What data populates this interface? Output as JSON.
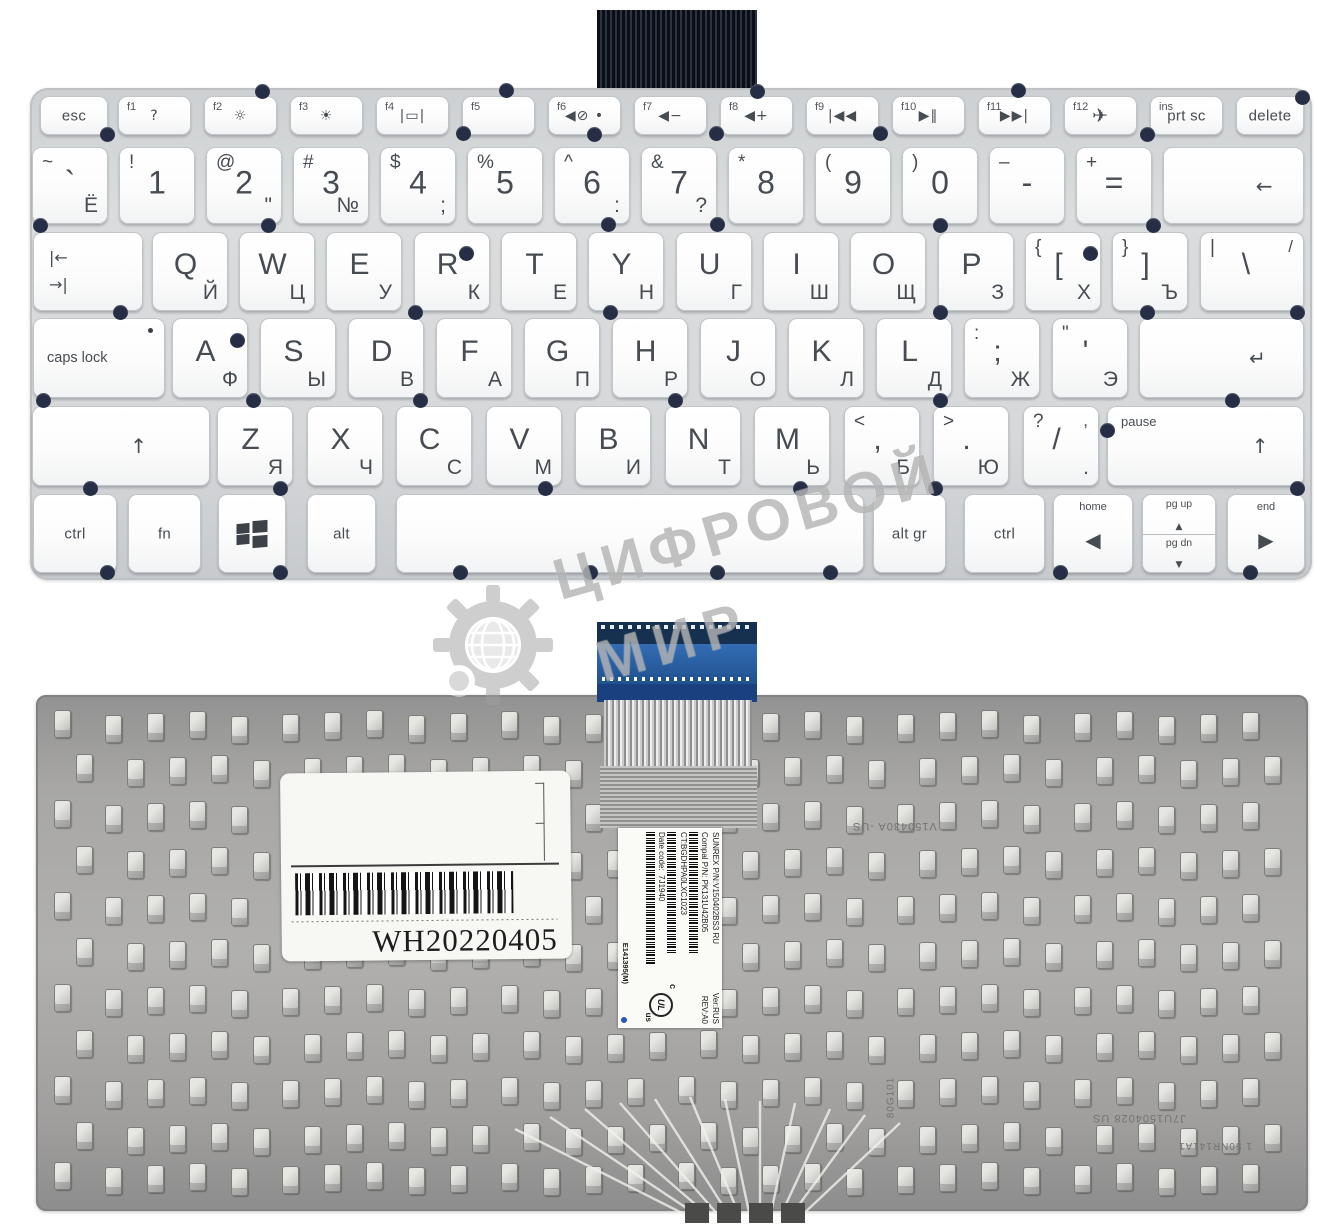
{
  "colors": {
    "cable_blue": "#2a5ca8",
    "front_plate": "#d6d8da",
    "back_plate": "#a5a4a2",
    "screw_dot": "#252e44",
    "key_text": "#474c52"
  },
  "watermark": {
    "word1": "ЦИФРОВОЙ",
    "word2": "МИР"
  },
  "front": {
    "rows": [
      {
        "y": 96,
        "h": 37,
        "cls": "row-fn",
        "mainCls": "word",
        "keys": [
          {
            "id": "esc",
            "x": 40,
            "w": 66,
            "main": "esc"
          },
          {
            "id": "f1",
            "x": 118,
            "w": 71,
            "fn": "f1",
            "icon": "question-icon"
          },
          {
            "id": "f2",
            "x": 204,
            "w": 71,
            "fn": "f2",
            "icon": "brightness-down-icon"
          },
          {
            "id": "f3",
            "x": 290,
            "w": 71,
            "fn": "f3",
            "icon": "brightness-up-icon"
          },
          {
            "id": "f4",
            "x": 376,
            "w": 71,
            "fn": "f4",
            "icon": "display-icon"
          },
          {
            "id": "f5",
            "x": 462,
            "w": 71,
            "fn": "f5"
          },
          {
            "id": "f6",
            "x": 548,
            "w": 71,
            "fn": "f6",
            "icon": "mute-icon"
          },
          {
            "id": "f7",
            "x": 634,
            "w": 71,
            "fn": "f7",
            "icon": "volume-down-icon"
          },
          {
            "id": "f8",
            "x": 720,
            "w": 71,
            "fn": "f8",
            "icon": "volume-up-icon"
          },
          {
            "id": "f9",
            "x": 806,
            "w": 71,
            "fn": "f9",
            "icon": "prev-track-icon"
          },
          {
            "id": "f10",
            "x": 892,
            "w": 71,
            "fn": "f10",
            "icon": "play-pause-icon"
          },
          {
            "id": "f11",
            "x": 978,
            "w": 71,
            "fn": "f11",
            "icon": "next-track-icon"
          },
          {
            "id": "f12",
            "x": 1064,
            "w": 71,
            "fn": "f12",
            "icon": "airplane-icon"
          },
          {
            "id": "prtsc",
            "x": 1150,
            "w": 71,
            "fn": "ins",
            "main": "prt sc"
          },
          {
            "id": "delete",
            "x": 1236,
            "w": 66,
            "main": "delete"
          }
        ]
      },
      {
        "y": 147,
        "h": 75,
        "mainCls": "num",
        "keys": [
          {
            "id": "grave",
            "x": 32,
            "w": 74,
            "tl": "~",
            "main": "`",
            "br": "Ё"
          },
          {
            "id": "1",
            "x": 119,
            "w": 74,
            "tl": "!",
            "main": "1"
          },
          {
            "id": "2",
            "x": 206,
            "w": 74,
            "tl": "@",
            "main": "2",
            "br": "\""
          },
          {
            "id": "3",
            "x": 293,
            "w": 74,
            "tl": "#",
            "main": "3",
            "br": "№"
          },
          {
            "id": "4",
            "x": 380,
            "w": 74,
            "tl": "$",
            "main": "4",
            "br": ";"
          },
          {
            "id": "5",
            "x": 467,
            "w": 74,
            "tl": "%",
            "main": "5"
          },
          {
            "id": "6",
            "x": 554,
            "w": 74,
            "tl": "^",
            "main": "6",
            "br": ":"
          },
          {
            "id": "7",
            "x": 641,
            "w": 74,
            "tl": "&",
            "main": "7",
            "br": "?"
          },
          {
            "id": "8",
            "x": 728,
            "w": 74,
            "tl": "*",
            "main": "8"
          },
          {
            "id": "9",
            "x": 815,
            "w": 74,
            "tl": "(",
            "main": "9"
          },
          {
            "id": "0",
            "x": 902,
            "w": 74,
            "tl": ")",
            "main": "0"
          },
          {
            "id": "minus",
            "x": 989,
            "w": 74,
            "tl": "–",
            "main": "-"
          },
          {
            "id": "equals",
            "x": 1076,
            "w": 74,
            "tl": "+",
            "main": "="
          },
          {
            "id": "backspace",
            "x": 1163,
            "w": 139,
            "icon": "backspace-icon",
            "ix": 72
          }
        ]
      },
      {
        "y": 232,
        "h": 77,
        "mainCls": "alpha",
        "keys": [
          {
            "id": "tab",
            "x": 33,
            "w": 108,
            "icon": "tab-icon"
          },
          {
            "id": "q",
            "x": 152,
            "w": 74,
            "main": "Q",
            "br": "Й"
          },
          {
            "id": "w",
            "x": 239,
            "w": 74,
            "main": "W",
            "br": "Ц"
          },
          {
            "id": "e",
            "x": 326,
            "w": 74,
            "main": "E",
            "br": "У"
          },
          {
            "id": "r",
            "x": 414,
            "w": 74,
            "main": "R",
            "br": "К"
          },
          {
            "id": "t",
            "x": 501,
            "w": 74,
            "main": "T",
            "br": "Е"
          },
          {
            "id": "y",
            "x": 588,
            "w": 74,
            "main": "Y",
            "br": "Н"
          },
          {
            "id": "u",
            "x": 676,
            "w": 74,
            "main": "U",
            "br": "Г"
          },
          {
            "id": "i",
            "x": 763,
            "w": 74,
            "main": "I",
            "br": "Ш"
          },
          {
            "id": "o",
            "x": 850,
            "w": 74,
            "main": "O",
            "br": "Щ"
          },
          {
            "id": "p",
            "x": 938,
            "w": 74,
            "main": "P",
            "br": "З"
          },
          {
            "id": "bracket-left",
            "x": 1025,
            "w": 74,
            "tl": "{",
            "main": "[",
            "br": "Х"
          },
          {
            "id": "bracket-right",
            "x": 1112,
            "w": 74,
            "tl": "}",
            "main": "]",
            "br": "Ъ"
          },
          {
            "id": "backslash",
            "x": 1200,
            "w": 102,
            "tl": "|",
            "tr": "/",
            "main": "\\"
          }
        ]
      },
      {
        "y": 318,
        "h": 78,
        "mainCls": "alpha",
        "keys": [
          {
            "id": "caps",
            "x": 33,
            "w": 130,
            "main": "caps lock",
            "align": "left",
            "dot": true
          },
          {
            "id": "a",
            "x": 172,
            "w": 74,
            "main": "A",
            "br": "Ф"
          },
          {
            "id": "s",
            "x": 260,
            "w": 74,
            "main": "S",
            "br": "Ы"
          },
          {
            "id": "d",
            "x": 348,
            "w": 74,
            "main": "D",
            "br": "В"
          },
          {
            "id": "f",
            "x": 436,
            "w": 74,
            "main": "F",
            "br": "А"
          },
          {
            "id": "g",
            "x": 524,
            "w": 74,
            "main": "G",
            "br": "П"
          },
          {
            "id": "h",
            "x": 612,
            "w": 74,
            "main": "H",
            "br": "Р"
          },
          {
            "id": "j",
            "x": 700,
            "w": 74,
            "main": "J",
            "br": "О"
          },
          {
            "id": "k",
            "x": 788,
            "w": 74,
            "main": "K",
            "br": "Л"
          },
          {
            "id": "l",
            "x": 876,
            "w": 74,
            "main": "L",
            "br": "Д"
          },
          {
            "id": "semicolon",
            "x": 964,
            "w": 74,
            "tl": ":",
            "main": ";",
            "br": "Ж"
          },
          {
            "id": "quote",
            "x": 1052,
            "w": 74,
            "tl": "\"",
            "main": "'",
            "br": "Э"
          },
          {
            "id": "enter",
            "x": 1139,
            "w": 163,
            "icon": "enter-icon",
            "ix": 72
          }
        ]
      },
      {
        "y": 406,
        "h": 78,
        "mainCls": "alpha",
        "keys": [
          {
            "id": "shift-left",
            "x": 32,
            "w": 176,
            "icon": "shift-icon",
            "ix": 60
          },
          {
            "id": "z",
            "x": 217,
            "w": 74,
            "main": "Z",
            "br": "Я"
          },
          {
            "id": "x",
            "x": 307,
            "w": 74,
            "main": "X",
            "br": "Ч"
          },
          {
            "id": "c",
            "x": 396,
            "w": 74,
            "main": "C",
            "br": "С"
          },
          {
            "id": "v",
            "x": 486,
            "w": 74,
            "main": "V",
            "br": "М"
          },
          {
            "id": "b",
            "x": 575,
            "w": 74,
            "main": "B",
            "br": "И"
          },
          {
            "id": "n",
            "x": 665,
            "w": 74,
            "main": "N",
            "br": "Т"
          },
          {
            "id": "m",
            "x": 754,
            "w": 74,
            "main": "M",
            "br": "Ь"
          },
          {
            "id": "comma",
            "x": 844,
            "w": 74,
            "tl": "<",
            "main": ",",
            "br": "Б"
          },
          {
            "id": "period",
            "x": 933,
            "w": 74,
            "tl": ">",
            "main": ".",
            "br": "Ю"
          },
          {
            "id": "slash",
            "x": 1023,
            "w": 74,
            "tl": "?",
            "tr": ",",
            "main": "/",
            "br": "."
          },
          {
            "id": "shift-right",
            "x": 1107,
            "w": 195,
            "small_tl": "pause",
            "icon": "shift-icon",
            "ix": 78
          }
        ]
      },
      {
        "y": 494,
        "h": 77,
        "mainCls": "word",
        "keys": [
          {
            "id": "ctrl-left",
            "x": 33,
            "w": 82,
            "main": "ctrl"
          },
          {
            "id": "fn-key",
            "x": 128,
            "w": 71,
            "main": "fn"
          },
          {
            "id": "win",
            "x": 218,
            "w": 66,
            "icon": "windows-icon"
          },
          {
            "id": "alt",
            "x": 307,
            "w": 67,
            "main": "alt"
          },
          {
            "id": "space",
            "x": 396,
            "w": 466
          },
          {
            "id": "altgr",
            "x": 873,
            "w": 71,
            "main": "alt gr"
          },
          {
            "id": "ctrl-right",
            "x": 964,
            "w": 79,
            "main": "ctrl"
          },
          {
            "id": "arrow-left",
            "x": 1053,
            "w": 78,
            "small": "home",
            "icon": "left-icon"
          },
          {
            "id": "page-keys",
            "x": 1142,
            "w": 72,
            "split": [
              {
                "label": "pg up",
                "icon": "up-icon"
              },
              {
                "label": "pg dn",
                "icon": "down-icon"
              }
            ]
          },
          {
            "id": "arrow-right",
            "x": 1227,
            "w": 76,
            "small": "end",
            "icon": "right-icon"
          }
        ]
      }
    ]
  },
  "back": {
    "sticker": {
      "code": "WH20220405"
    },
    "part_label": {
      "line1_left": "SUNREX P/N:V150402BS3 RU",
      "line1_right": "Ver:RUS",
      "line2_left": "Compal P/N: PK131U42B05",
      "line2_right": "REV:A0",
      "ct": "CT:BGDHPA0LXC1023",
      "date": "Date code:  7J1940",
      "cert": "E141395(M)",
      "ul_c": "c",
      "ul_mid": "UL",
      "ul_us": "us"
    },
    "plate_marks": [
      {
        "text": "V150430A -US"
      },
      {
        "text": "80G101"
      },
      {
        "text": "J7U1504028 US"
      },
      {
        "text": "1 50NR141A1"
      }
    ]
  }
}
